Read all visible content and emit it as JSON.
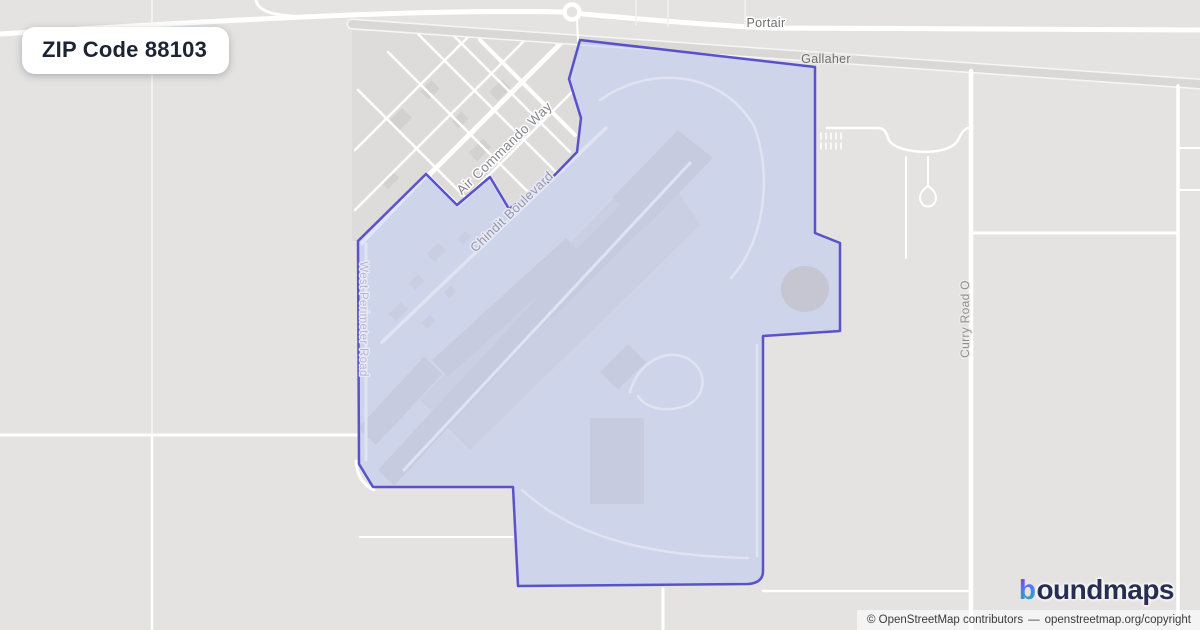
{
  "badge": {
    "title": "ZIP Code 88103"
  },
  "map": {
    "labels": {
      "portair": "Portair",
      "gallaher": "Gallaher",
      "air_commando_way": "Air Commando Way",
      "chindit_boulevard": "Chindit Boulevard",
      "west_perimeter_road": "West Perimeter Road",
      "curry_road_o": "Curry Road O"
    },
    "colors": {
      "map_background": "#e4e3e1",
      "zone_fill": "#cdd2ea",
      "zone_boundary": "#5a52c8",
      "road": "#ffffff",
      "runway": "#c6cbdf",
      "label_gray": "#6e6e6e",
      "badge_text": "#1c2333",
      "logo_navy": "#272e52",
      "logo_gradient_start": "#9333ea",
      "logo_gradient_mid": "#4f7cf0",
      "logo_gradient_end": "#14b8a6"
    }
  },
  "branding": {
    "logo_b": "b",
    "logo_rest": "oundmaps"
  },
  "attribution": {
    "copyright": "© OpenStreetMap contributors",
    "dash": "—",
    "link": "openstreetmap.org/copyright"
  }
}
